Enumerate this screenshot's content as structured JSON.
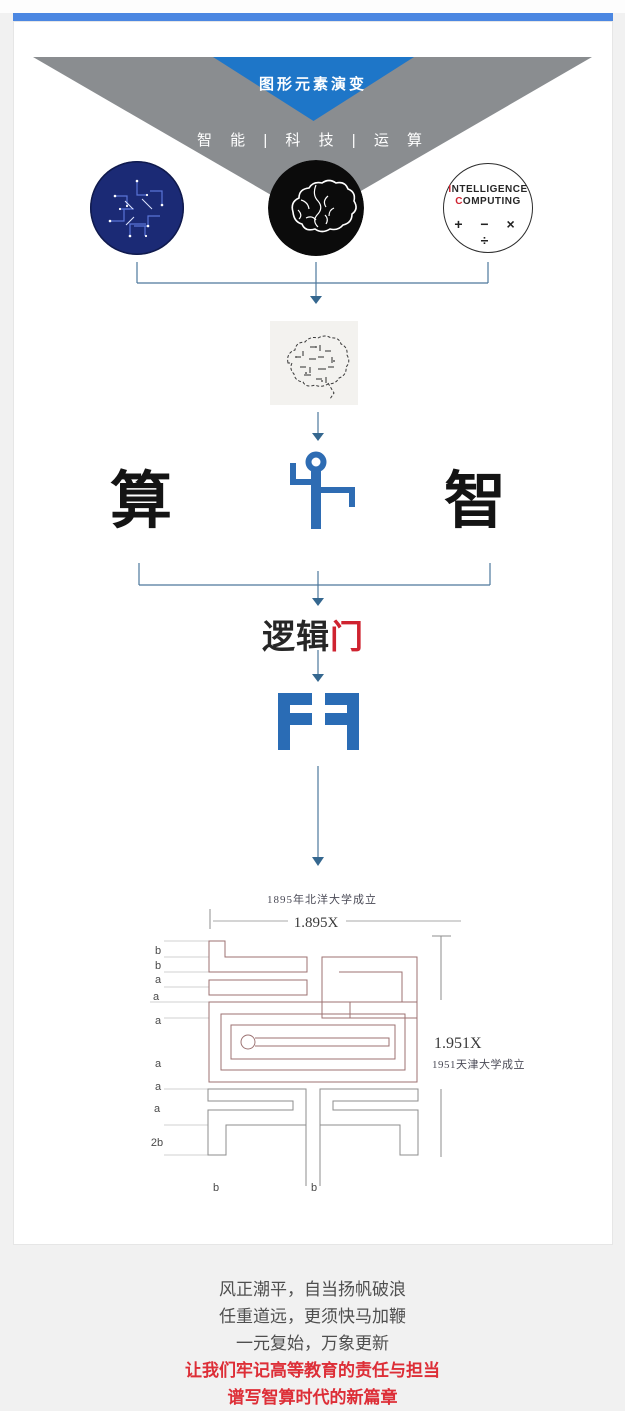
{
  "header": {
    "banner_title": "图形元素演变",
    "subtitle": "智 能 | 科 技 | 运 算"
  },
  "circles": {
    "computing": {
      "line1_first": "I",
      "line1_rest": "NTELLIGENCE",
      "line2_first": "C",
      "line2_rest": "OMPUTING",
      "operators": "+ − × ÷"
    }
  },
  "concepts": {
    "left": "算",
    "right": "智"
  },
  "logic_gate": {
    "black_part": "逻辑",
    "red_part": "门"
  },
  "drawing": {
    "top_caption": "1895年北洋大学成立",
    "top_dimension": "1.895X",
    "right_dimension": "1.951X",
    "right_caption": "1951天津大学成立",
    "left_labels": [
      "b",
      "b",
      "a",
      "a",
      "a",
      "a",
      "a",
      "a",
      "2b"
    ],
    "bottom_labels": [
      "b",
      "b"
    ]
  },
  "footer": {
    "lines": [
      "风正潮平，自当扬帆破浪",
      "任重道远，更须快马加鞭",
      "一元复始，万象更新"
    ],
    "highlight_lines": [
      "让我们牢记高等教育的责任与担当",
      "谱写智算时代的新篇章"
    ]
  },
  "colors": {
    "top_bar": "#4b87e2",
    "triangle_blue": "#1e76c8",
    "triangle_gray": "#8a8d90",
    "logo_blue": "#2e6cb3",
    "accent_red": "#cf2330",
    "connector": "#4d779c"
  }
}
